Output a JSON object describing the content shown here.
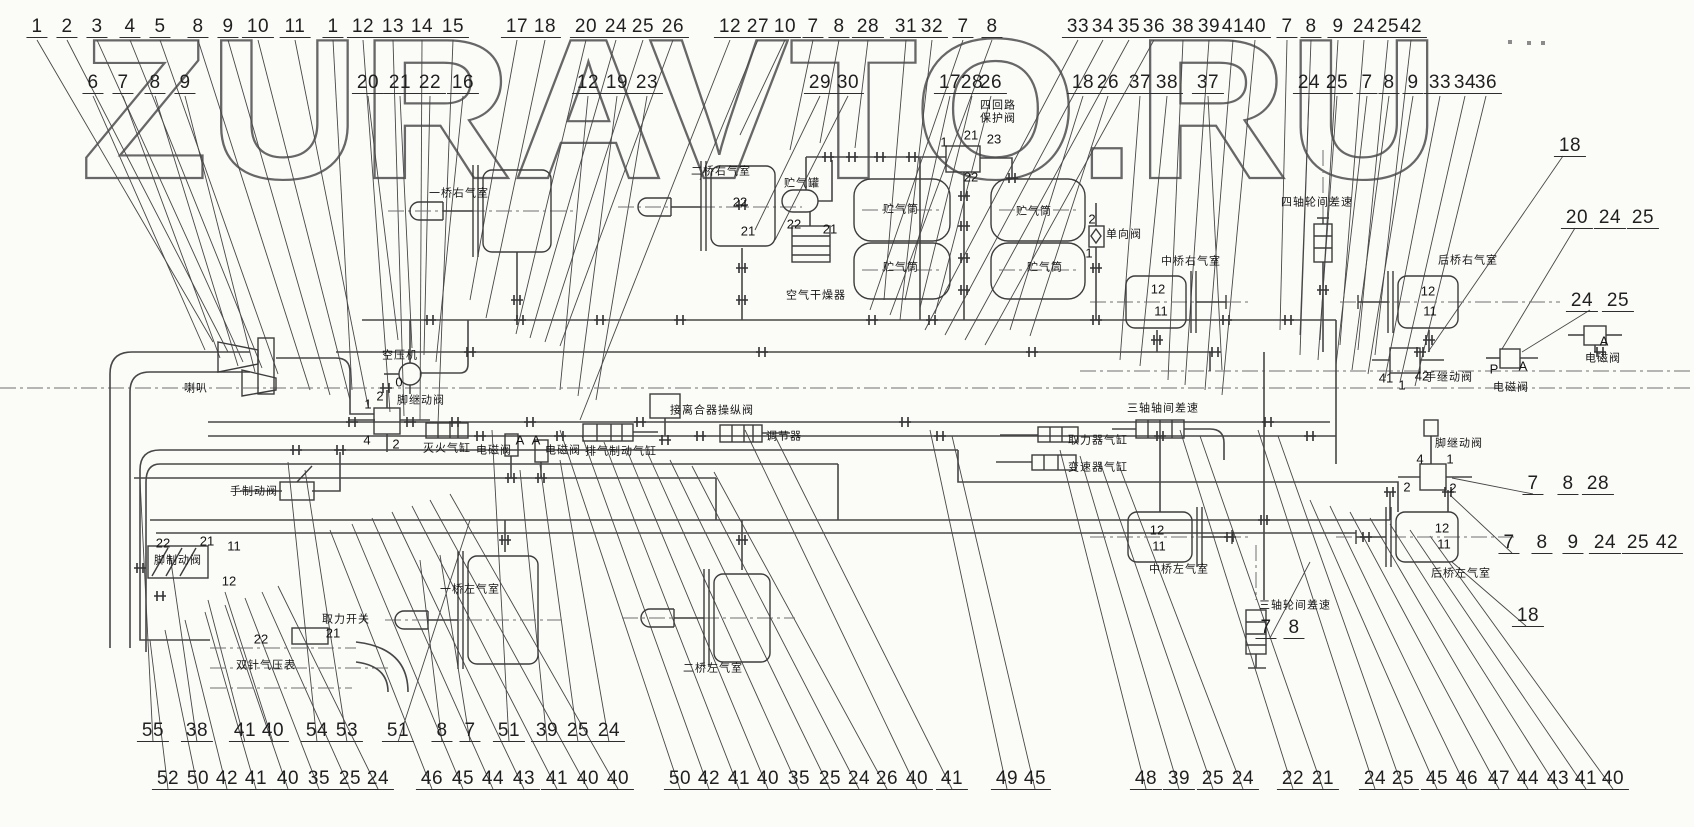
{
  "watermark": "ZURAVTO.RU",
  "callouts": {
    "rows": [
      {
        "name": "top-row-1",
        "top": 17,
        "items": [
          {
            "n": "1",
            "x": 37
          },
          {
            "n": "2",
            "x": 67
          },
          {
            "n": "3",
            "x": 97
          },
          {
            "n": "4",
            "x": 130
          },
          {
            "n": "5",
            "x": 160
          },
          {
            "n": "8",
            "x": 198
          },
          {
            "n": "9",
            "x": 228
          },
          {
            "n": "10",
            "x": 258
          },
          {
            "n": "11",
            "x": 295
          },
          {
            "n": "1",
            "x": 333
          },
          {
            "n": "12",
            "x": 363
          },
          {
            "n": "13",
            "x": 393
          },
          {
            "n": "14",
            "x": 422
          },
          {
            "n": "15",
            "x": 453
          },
          {
            "n": "17",
            "x": 517
          },
          {
            "n": "18",
            "x": 545
          },
          {
            "n": "20",
            "x": 586
          },
          {
            "n": "24",
            "x": 616
          },
          {
            "n": "25",
            "x": 643
          },
          {
            "n": "26",
            "x": 673
          },
          {
            "n": "12",
            "x": 730
          },
          {
            "n": "27",
            "x": 758
          },
          {
            "n": "10",
            "x": 785
          },
          {
            "n": "7",
            "x": 813
          },
          {
            "n": "8",
            "x": 839
          },
          {
            "n": "28",
            "x": 868
          },
          {
            "n": "31",
            "x": 906
          },
          {
            "n": "32",
            "x": 932
          },
          {
            "n": "7",
            "x": 963
          },
          {
            "n": "8",
            "x": 992
          },
          {
            "n": "33",
            "x": 1078
          },
          {
            "n": "34",
            "x": 1103
          },
          {
            "n": "35",
            "x": 1129
          },
          {
            "n": "36",
            "x": 1154
          },
          {
            "n": "38",
            "x": 1183
          },
          {
            "n": "39",
            "x": 1209
          },
          {
            "n": "41",
            "x": 1233
          },
          {
            "n": "40",
            "x": 1255
          },
          {
            "n": "7",
            "x": 1287
          },
          {
            "n": "8",
            "x": 1311
          },
          {
            "n": "9",
            "x": 1338
          },
          {
            "n": "24",
            "x": 1364
          },
          {
            "n": "25",
            "x": 1388
          },
          {
            "n": "42",
            "x": 1411
          }
        ]
      },
      {
        "name": "top-row-2",
        "top": 73,
        "items": [
          {
            "n": "6",
            "x": 93
          },
          {
            "n": "7",
            "x": 123
          },
          {
            "n": "8",
            "x": 155
          },
          {
            "n": "9",
            "x": 185
          },
          {
            "n": "20",
            "x": 368
          },
          {
            "n": "21",
            "x": 400
          },
          {
            "n": "22",
            "x": 430
          },
          {
            "n": "16",
            "x": 463
          },
          {
            "n": "12",
            "x": 588
          },
          {
            "n": "19",
            "x": 617
          },
          {
            "n": "23",
            "x": 647
          },
          {
            "n": "29",
            "x": 820
          },
          {
            "n": "30",
            "x": 848
          },
          {
            "n": "17",
            "x": 950
          },
          {
            "n": "28",
            "x": 972
          },
          {
            "n": "26",
            "x": 991
          },
          {
            "n": "18",
            "x": 1083
          },
          {
            "n": "26",
            "x": 1108
          },
          {
            "n": "37",
            "x": 1140
          },
          {
            "n": "38",
            "x": 1167
          },
          {
            "n": "37",
            "x": 1208
          },
          {
            "n": "24",
            "x": 1309
          },
          {
            "n": "25",
            "x": 1337
          },
          {
            "n": "7",
            "x": 1367
          },
          {
            "n": "8",
            "x": 1389
          },
          {
            "n": "9",
            "x": 1413
          },
          {
            "n": "33",
            "x": 1440
          },
          {
            "n": "34",
            "x": 1465
          },
          {
            "n": "36",
            "x": 1486
          }
        ]
      },
      {
        "name": "right-group-18",
        "top": 136,
        "items": [
          {
            "n": "18",
            "x": 1570
          }
        ]
      },
      {
        "name": "right-group-20-24-25",
        "top": 208,
        "items": [
          {
            "n": "20",
            "x": 1577
          },
          {
            "n": "24",
            "x": 1610
          },
          {
            "n": "25",
            "x": 1643
          }
        ]
      },
      {
        "name": "right-group-24-25",
        "top": 291,
        "items": [
          {
            "n": "24",
            "x": 1582
          },
          {
            "n": "25",
            "x": 1618
          }
        ]
      },
      {
        "name": "right-group-7-8-28",
        "top": 474,
        "items": [
          {
            "n": "7",
            "x": 1533
          },
          {
            "n": "8",
            "x": 1568
          },
          {
            "n": "28",
            "x": 1598
          }
        ]
      },
      {
        "name": "right-group-7-8-9-24-25-42",
        "top": 533,
        "items": [
          {
            "n": "7",
            "x": 1509
          },
          {
            "n": "8",
            "x": 1542
          },
          {
            "n": "9",
            "x": 1573
          },
          {
            "n": "24",
            "x": 1605
          },
          {
            "n": "25",
            "x": 1638
          },
          {
            "n": "42",
            "x": 1667
          }
        ]
      },
      {
        "name": "right-group-18b",
        "top": 606,
        "items": [
          {
            "n": "18",
            "x": 1528
          }
        ]
      },
      {
        "name": "right-group-7-8",
        "top": 618,
        "items": [
          {
            "n": "7",
            "x": 1266
          },
          {
            "n": "8",
            "x": 1294
          }
        ]
      },
      {
        "name": "bottom-row-1",
        "top": 721,
        "items": [
          {
            "n": "55",
            "x": 153
          },
          {
            "n": "38",
            "x": 197
          },
          {
            "n": "41",
            "x": 245
          },
          {
            "n": "40",
            "x": 273
          },
          {
            "n": "54",
            "x": 317
          },
          {
            "n": "53",
            "x": 347
          },
          {
            "n": "51",
            "x": 398
          },
          {
            "n": "8",
            "x": 442
          },
          {
            "n": "7",
            "x": 470
          },
          {
            "n": "51",
            "x": 509
          },
          {
            "n": "39",
            "x": 547
          },
          {
            "n": "25",
            "x": 578
          },
          {
            "n": "24",
            "x": 609
          }
        ]
      },
      {
        "name": "bottom-row-2",
        "top": 769,
        "items": [
          {
            "n": "52",
            "x": 168
          },
          {
            "n": "50",
            "x": 198
          },
          {
            "n": "42",
            "x": 227
          },
          {
            "n": "41",
            "x": 256
          },
          {
            "n": "40",
            "x": 288
          },
          {
            "n": "35",
            "x": 319
          },
          {
            "n": "25",
            "x": 350
          },
          {
            "n": "24",
            "x": 378
          },
          {
            "n": "46",
            "x": 432
          },
          {
            "n": "45",
            "x": 463
          },
          {
            "n": "44",
            "x": 493
          },
          {
            "n": "43",
            "x": 524
          },
          {
            "n": "41",
            "x": 557
          },
          {
            "n": "40",
            "x": 588
          },
          {
            "n": "40",
            "x": 618
          },
          {
            "n": "50",
            "x": 680
          },
          {
            "n": "42",
            "x": 709
          },
          {
            "n": "41",
            "x": 739
          },
          {
            "n": "40",
            "x": 768
          },
          {
            "n": "35",
            "x": 799
          },
          {
            "n": "25",
            "x": 830
          },
          {
            "n": "24",
            "x": 859
          },
          {
            "n": "26",
            "x": 887
          },
          {
            "n": "40",
            "x": 917
          },
          {
            "n": "41",
            "x": 952
          },
          {
            "n": "49",
            "x": 1007
          },
          {
            "n": "45",
            "x": 1035
          },
          {
            "n": "48",
            "x": 1146
          },
          {
            "n": "39",
            "x": 1179
          },
          {
            "n": "25",
            "x": 1213
          },
          {
            "n": "24",
            "x": 1243
          },
          {
            "n": "22",
            "x": 1293
          },
          {
            "n": "21",
            "x": 1323
          },
          {
            "n": "24",
            "x": 1375
          },
          {
            "n": "25",
            "x": 1403
          },
          {
            "n": "45",
            "x": 1437
          },
          {
            "n": "46",
            "x": 1467
          },
          {
            "n": "47",
            "x": 1499
          },
          {
            "n": "44",
            "x": 1528
          },
          {
            "n": "43",
            "x": 1558
          },
          {
            "n": "41",
            "x": 1586
          },
          {
            "n": "40",
            "x": 1613
          }
        ]
      }
    ]
  },
  "component_labels": [
    {
      "text": "喇叭",
      "x": 196,
      "y": 389
    },
    {
      "text": "空压机",
      "x": 400,
      "y": 356
    },
    {
      "text": "脚继动阀",
      "x": 421,
      "y": 401
    },
    {
      "text": "灭火气缸",
      "x": 447,
      "y": 449
    },
    {
      "text": "电磁阀",
      "x": 494,
      "y": 451
    },
    {
      "text": "电磁阀",
      "x": 563,
      "y": 451
    },
    {
      "text": "排气制动气缸",
      "x": 621,
      "y": 452
    },
    {
      "text": "接离合器操纵阀",
      "x": 712,
      "y": 411
    },
    {
      "text": "调节器",
      "x": 784,
      "y": 437
    },
    {
      "text": "手制动阀",
      "x": 254,
      "y": 492
    },
    {
      "text": "脚制动阀",
      "x": 178,
      "y": 561
    },
    {
      "text": "取力开关",
      "x": 346,
      "y": 620
    },
    {
      "text": "双针气压表",
      "x": 266,
      "y": 666
    },
    {
      "text": "一桥右气室",
      "x": 459,
      "y": 194
    },
    {
      "text": "二桥右气室",
      "x": 721,
      "y": 172
    },
    {
      "text": "一桥左气室",
      "x": 470,
      "y": 590
    },
    {
      "text": "二桥左气室",
      "x": 713,
      "y": 669
    },
    {
      "text": "贮气罐",
      "x": 802,
      "y": 184
    },
    {
      "text": "空气干燥器",
      "x": 816,
      "y": 296
    },
    {
      "text": "贮气筒",
      "x": 901,
      "y": 210
    },
    {
      "text": "贮气筒",
      "x": 901,
      "y": 268
    },
    {
      "text": "贮气筒",
      "x": 1034,
      "y": 212
    },
    {
      "text": "贮气筒",
      "x": 1045,
      "y": 268
    },
    {
      "text": "四回路\n保护阀",
      "x": 998,
      "y": 112
    },
    {
      "text": "单向阀",
      "x": 1124,
      "y": 235
    },
    {
      "text": "中桥右气室",
      "x": 1191,
      "y": 262
    },
    {
      "text": "四轴轮间差速",
      "x": 1317,
      "y": 203
    },
    {
      "text": "后桥右气室",
      "x": 1468,
      "y": 261
    },
    {
      "text": "取力器气缸",
      "x": 1098,
      "y": 441
    },
    {
      "text": "变速器气缸",
      "x": 1098,
      "y": 468
    },
    {
      "text": "三轴轴间差速",
      "x": 1163,
      "y": 409
    },
    {
      "text": "中桥左气室",
      "x": 1179,
      "y": 570
    },
    {
      "text": "三轴轮间差速",
      "x": 1295,
      "y": 606
    },
    {
      "text": "手继动阀",
      "x": 1449,
      "y": 378
    },
    {
      "text": "电磁阀",
      "x": 1511,
      "y": 388
    },
    {
      "text": "电磁阀",
      "x": 1603,
      "y": 359
    },
    {
      "text": "脚继动阀",
      "x": 1459,
      "y": 444
    },
    {
      "text": "后桥左气室",
      "x": 1461,
      "y": 574
    }
  ],
  "part_numbers": [
    {
      "t": "1",
      "x": 368,
      "y": 404
    },
    {
      "t": "2",
      "x": 380,
      "y": 396
    },
    {
      "t": "4",
      "x": 367,
      "y": 440
    },
    {
      "t": "2",
      "x": 396,
      "y": 444
    },
    {
      "t": "0",
      "x": 399,
      "y": 382
    },
    {
      "t": "22",
      "x": 163,
      "y": 543
    },
    {
      "t": "21",
      "x": 207,
      "y": 541
    },
    {
      "t": "11",
      "x": 234,
      "y": 546
    },
    {
      "t": "12",
      "x": 229,
      "y": 581
    },
    {
      "t": "22",
      "x": 261,
      "y": 639
    },
    {
      "t": "21",
      "x": 333,
      "y": 633
    },
    {
      "t": "A",
      "x": 520,
      "y": 440
    },
    {
      "t": "A",
      "x": 536,
      "y": 440
    },
    {
      "t": "22",
      "x": 740,
      "y": 202
    },
    {
      "t": "21",
      "x": 748,
      "y": 231
    },
    {
      "t": "1",
      "x": 944,
      "y": 142
    },
    {
      "t": "21",
      "x": 971,
      "y": 135
    },
    {
      "t": "23",
      "x": 994,
      "y": 139
    },
    {
      "t": "22",
      "x": 971,
      "y": 177
    },
    {
      "t": "22",
      "x": 794,
      "y": 224
    },
    {
      "t": "21",
      "x": 830,
      "y": 229
    },
    {
      "t": "2",
      "x": 1092,
      "y": 219
    },
    {
      "t": "1",
      "x": 1089,
      "y": 253
    },
    {
      "t": "12",
      "x": 1158,
      "y": 289
    },
    {
      "t": "11",
      "x": 1161,
      "y": 311
    },
    {
      "t": "12",
      "x": 1428,
      "y": 291
    },
    {
      "t": "11",
      "x": 1430,
      "y": 311
    },
    {
      "t": "12",
      "x": 1157,
      "y": 530
    },
    {
      "t": "11",
      "x": 1159,
      "y": 546
    },
    {
      "t": "12",
      "x": 1442,
      "y": 528
    },
    {
      "t": "11",
      "x": 1444,
      "y": 544
    },
    {
      "t": "41",
      "x": 1386,
      "y": 378
    },
    {
      "t": "1",
      "x": 1402,
      "y": 385
    },
    {
      "t": "42",
      "x": 1422,
      "y": 376
    },
    {
      "t": "P",
      "x": 1494,
      "y": 369
    },
    {
      "t": "A",
      "x": 1523,
      "y": 366
    },
    {
      "t": "A",
      "x": 1604,
      "y": 341
    },
    {
      "t": "4",
      "x": 1420,
      "y": 459
    },
    {
      "t": "1",
      "x": 1450,
      "y": 459
    },
    {
      "t": "2",
      "x": 1407,
      "y": 487
    },
    {
      "t": "2",
      "x": 1453,
      "y": 488
    }
  ],
  "scan_marks": [
    {
      "x": 1508,
      "y": 40
    },
    {
      "x": 1527,
      "y": 41
    },
    {
      "x": 1541,
      "y": 41
    }
  ]
}
